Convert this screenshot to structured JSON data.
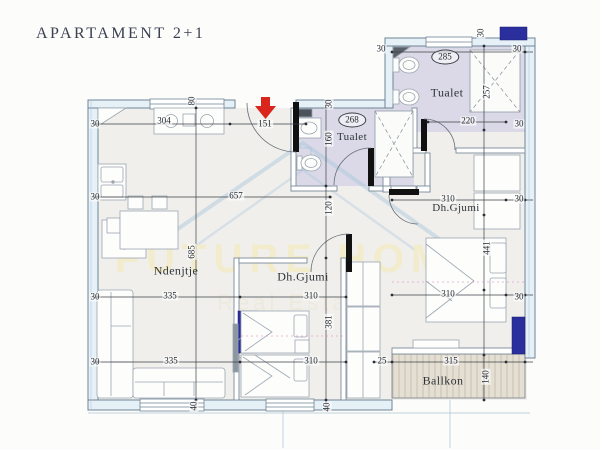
{
  "title": "APARTAMENT 2+1",
  "watermark": {
    "brand": "FUTURE HOME",
    "tagline": "Real Estate"
  },
  "rooms": {
    "bath_large": "Tualet",
    "bath_small": "Tualet",
    "living": "Ndenjtje",
    "bed_mid": "Dh.Gjumi",
    "bed_right": "Dh.Gjumi",
    "balcony": "Ballkon"
  },
  "dims": {
    "kitchen_w": "304",
    "entry_w": "151",
    "bath_small_w": "268",
    "bath_small_h": "160",
    "bath_large_w": "285",
    "bath_large_shower": "257",
    "bath_large_inner": "220",
    "living_w": "657",
    "hall_h": "120",
    "living_h": "685",
    "living_sofa": "335",
    "bed_mid_w": "310",
    "bed_mid_h": "381",
    "bed_right_w": "310",
    "bed_right_h": "441",
    "balcony_w": "315",
    "balcony_h": "140",
    "balcony_gap": "25",
    "wall": "30",
    "window": "40",
    "top_window": "80"
  },
  "colors": {
    "bath_floor": "#dbd9e7",
    "balcony_floor": "#e4dfd2",
    "marker_blue": "#2b2f9e",
    "arrow_red": "#d9251c",
    "watermark_text": "#f3ebc9",
    "watermark_house": "#a6c6dc"
  }
}
